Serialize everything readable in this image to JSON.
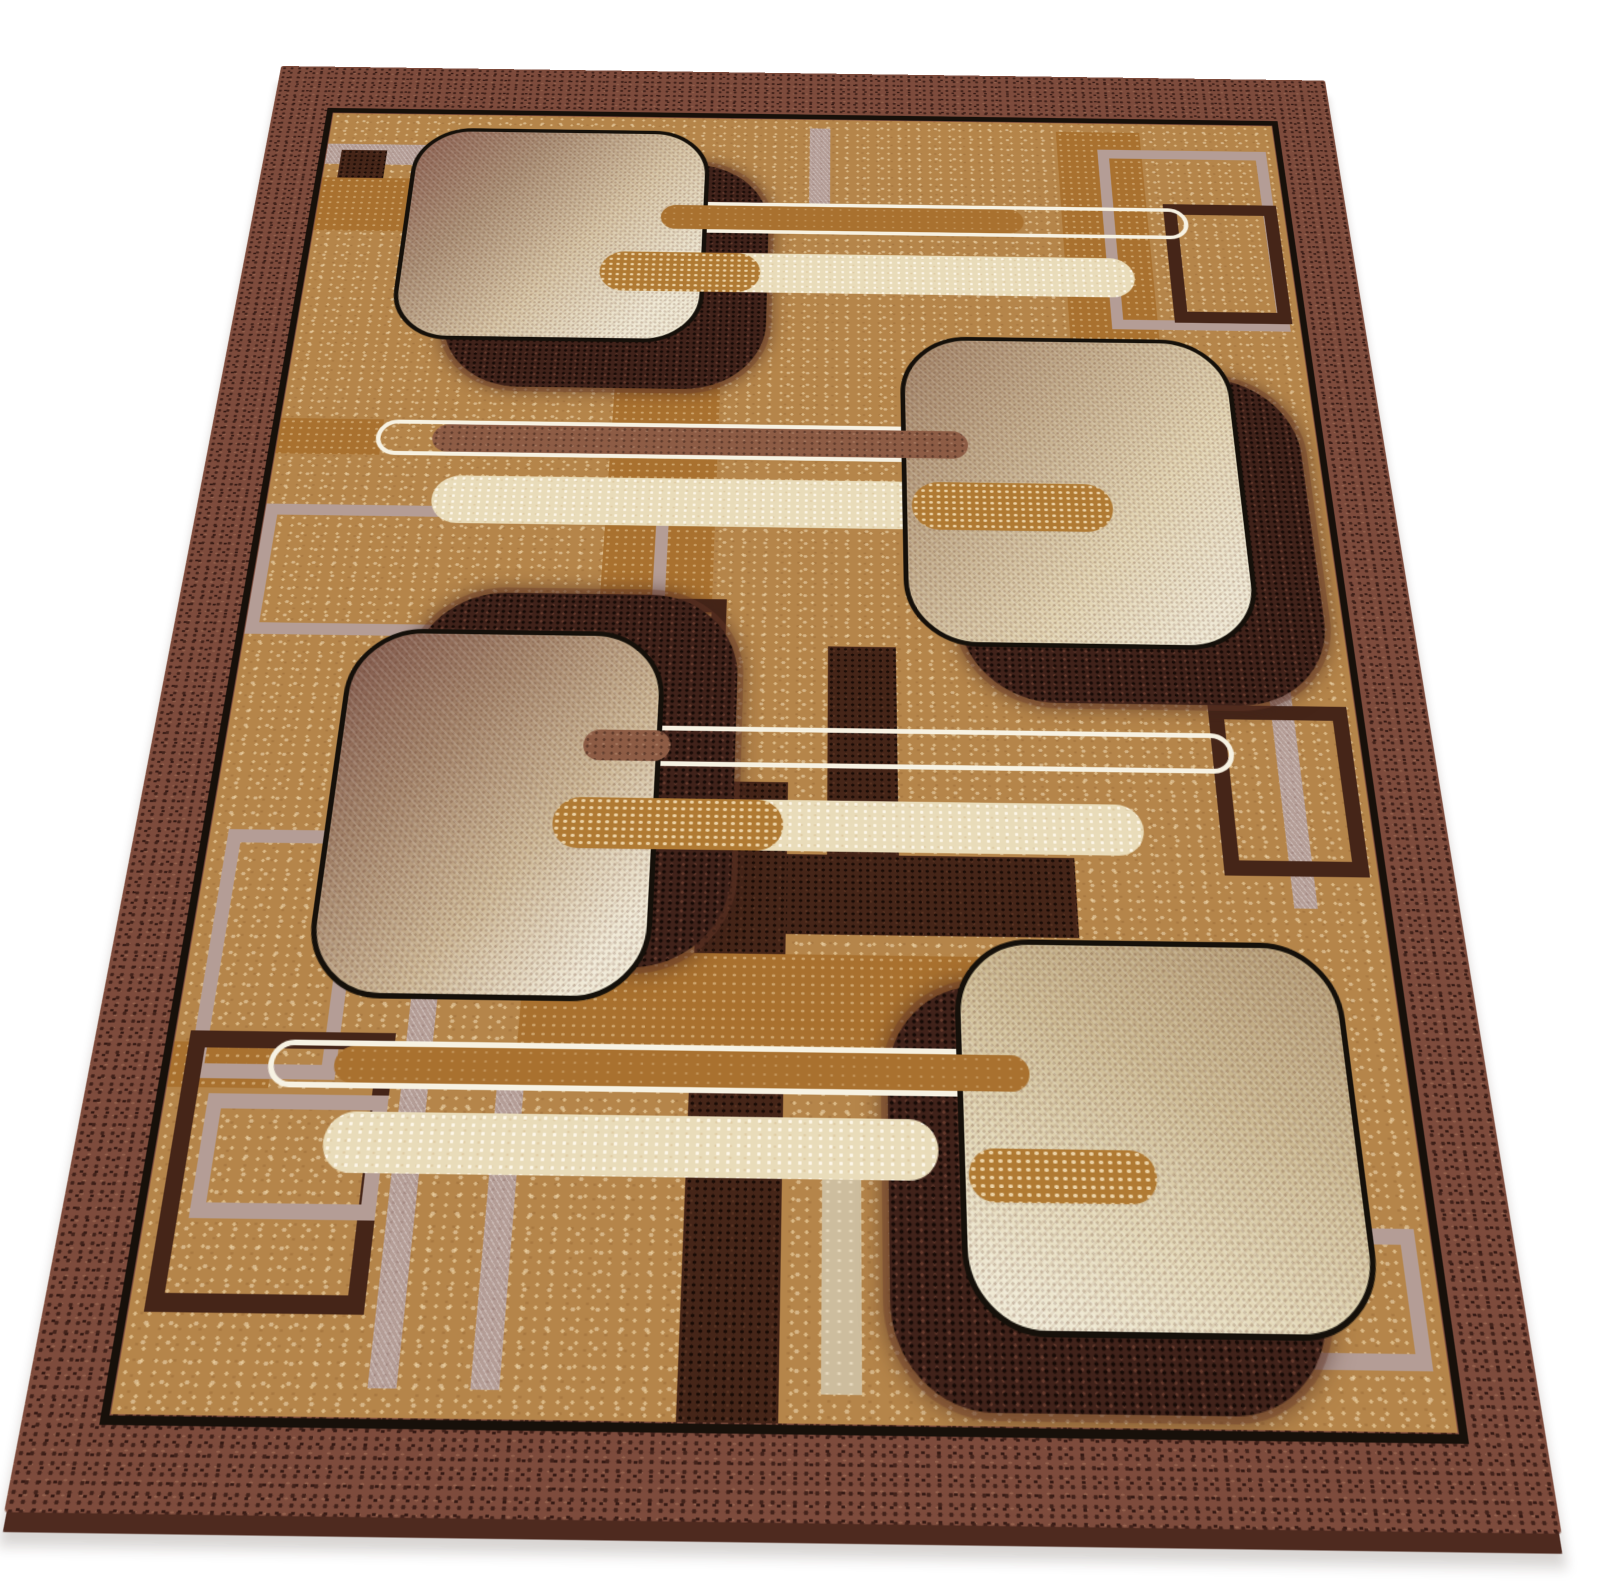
{
  "scene": {
    "alt": "Product photograph of a rectangular brown and beige area rug with a modern abstract geometric pattern, displayed in perspective against a plain white background",
    "subject": "area rug",
    "style": "retro modern abstract geometric",
    "view": "angled perspective product shot",
    "background": "#ffffff"
  },
  "rug": {
    "border": "wide speckled maroon-brown frame",
    "inner_line": "thin near-black rectangular outline inside the border",
    "field": "camel-tan ground with light cream speckle texture",
    "square_count": 4,
    "squares": "four large rounded squares with woven gradient fill from dusty mauve-brown to cream, each with a thin black outline and an offset dark espresso speckled shadow block",
    "pill_groups": 4,
    "pills": "horizontal capsule stripes: white-outlined capsules, cream speckled capsules, and caramel capsules that tuck into the squares with rounded caps",
    "background_motifs": "thin open rectangles and stripes in rosy mauve and dark espresso, plus caramel and espresso bars crossing the field"
  },
  "palette": {
    "bg_white": "#ffffff",
    "border_maroon": "#7d4b3c",
    "line_black": "#17100a",
    "field_tan": "#b5854a",
    "caramel": "#a9712f",
    "caramel_speckled": "#b07a33",
    "dusty_caramel": "#8d5c45",
    "espresso": "#452518",
    "mauve": "#b49d96",
    "pale_sand": "#cdbd9e",
    "cream_pill": "#e9dcba",
    "white_pill": "#f7f2e3",
    "square_dark_corner": "#7f574b",
    "square_cream": "#efe8d3",
    "shadow_espresso": "#40221a",
    "rug_side": "#4e2a1f"
  }
}
